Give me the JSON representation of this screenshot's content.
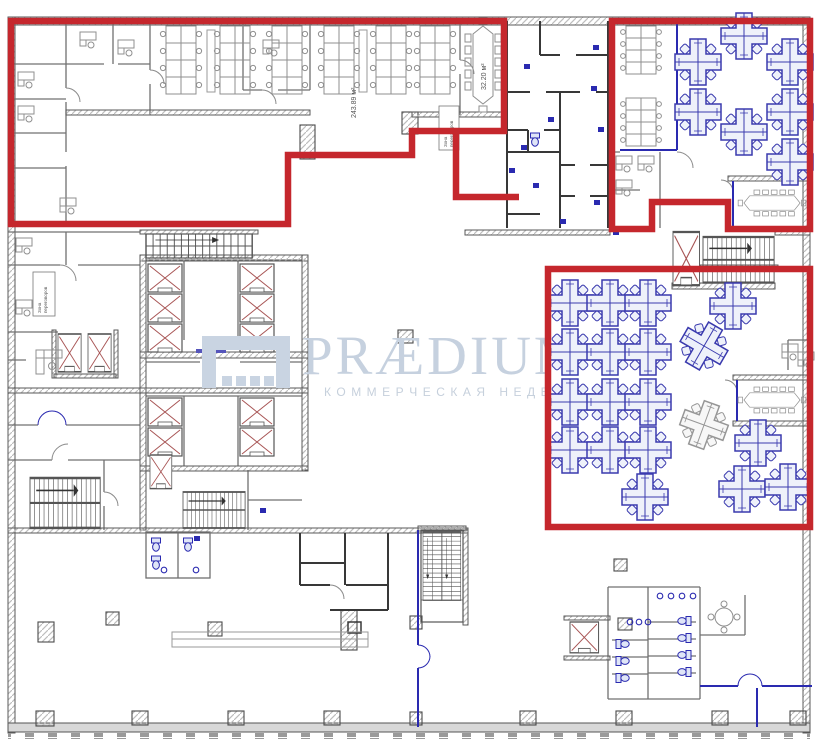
{
  "watermark": {
    "brand": "PRÆDIUM",
    "tagline": "КОММЕРЧЕСКАЯ НЕДВИЖ",
    "color": "#c9d3e1"
  },
  "labels": {
    "open_office_area": "243.89 м²",
    "meeting_room_area": "32.20 м²",
    "room_tag_line1": "Зона",
    "room_tag_line2": "переговоров"
  },
  "colors": {
    "highlight_red": "#c5272d",
    "furniture_blue": "#3a3aae",
    "partition_blue": "#2a2ab0",
    "wall_grey": "#4a4a4a",
    "wall_dark": "#383838",
    "shaft_x_red": "#a85555",
    "watermark_blue": "#c9d3e1"
  }
}
